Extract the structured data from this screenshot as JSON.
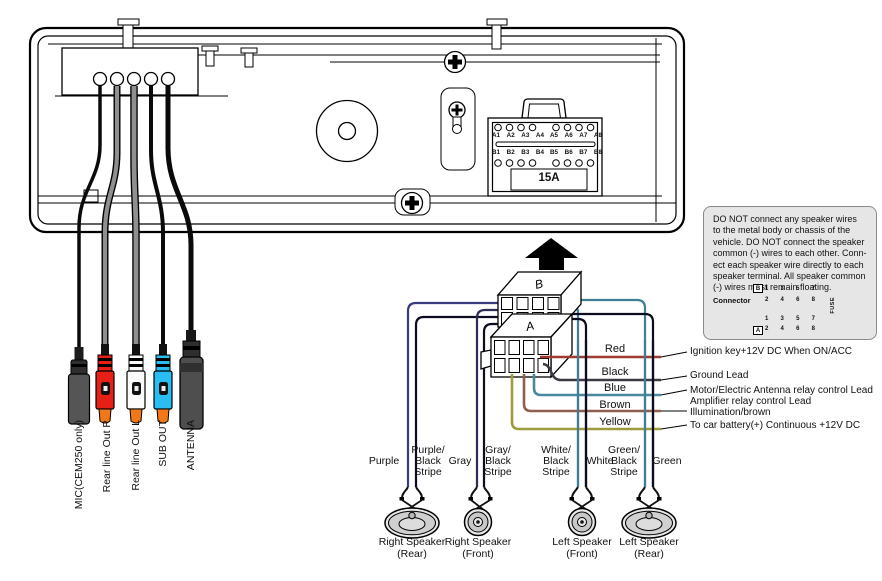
{
  "unit": {
    "pin_labels_a": [
      "A1",
      "A2",
      "A3",
      "A4",
      "A5",
      "A6",
      "A7",
      "A8"
    ],
    "pin_labels_b": [
      "B1",
      "B2",
      "B3",
      "B4",
      "B5",
      "B6",
      "B7",
      "B8"
    ],
    "fuse_label": "15A"
  },
  "harness": {
    "block_a_label": "A",
    "block_b_label": "B"
  },
  "outputs": {
    "items": [
      {
        "label": "MIC(CEM250 only)",
        "plug_color": "#555555"
      },
      {
        "label": "Rear line Out R",
        "plug_color": "#e62017"
      },
      {
        "label": "Rear line Out L",
        "plug_color": "#fcfcfc"
      },
      {
        "label": "SUB OUT",
        "plug_color": "#29bdf2"
      },
      {
        "label": "ANTENNA",
        "plug_color": "#4e4e4e"
      }
    ],
    "tip_color": "#f07818"
  },
  "power_wires": {
    "items": [
      {
        "color_label": "Red",
        "hex": "#9e3a32",
        "description": "Ignition key+12V DC When ON/ACC"
      },
      {
        "color_label": "Black",
        "hex": "#3a3a42",
        "description": "Ground Lead"
      },
      {
        "color_label": "Blue",
        "hex": "#4a87a0",
        "description": "Motor/Electric Antenna relay control Lead",
        "description2": "Amplifier relay control Lead"
      },
      {
        "color_label": "Brown",
        "hex": "#8e5f4e",
        "description": "Illumination/brown"
      },
      {
        "color_label": "Yellow",
        "hex": "#9c9c3c",
        "description": "To car battery(+) Continuous +12V DC"
      }
    ]
  },
  "speakers": {
    "items": [
      {
        "left_lines": [
          "Purple"
        ],
        "right_lines": [
          "Purple/",
          "Black",
          "Stripe"
        ],
        "name_lines": [
          "Right Speaker",
          "(Rear)"
        ],
        "shape": "oval"
      },
      {
        "left_lines": [
          "Gray"
        ],
        "right_lines": [
          "Gray/",
          "Black",
          "Stripe"
        ],
        "name_lines": [
          "Right Speaker",
          "(Front)"
        ],
        "shape": "round"
      },
      {
        "left_lines": [
          "White/",
          "Black",
          "Stripe"
        ],
        "right_lines": [
          "White"
        ],
        "name_lines": [
          "Left Speaker",
          "(Front)"
        ],
        "shape": "round"
      },
      {
        "left_lines": [
          "Green/",
          "Black",
          "Stripe"
        ],
        "right_lines": [
          "Green"
        ],
        "name_lines": [
          "Left Speaker",
          "(Rear)"
        ],
        "shape": "oval"
      }
    ]
  },
  "note_box": {
    "lines": [
      "DO NOT connect any speaker wires",
      "to the metal body or chassis of the",
      "vehicle. DO NOT connect the speaker",
      "common (-) wires to each other. Conn-",
      "ect each speaker wire directly to each",
      "speaker terminal. All speaker common",
      "(-) wires must remain floating."
    ],
    "connector_label": "Connector",
    "fuse_label": "FUSE",
    "block_a_label": "A",
    "block_b_label": "B",
    "pin_numbers_top": [
      "1",
      "3",
      "5",
      "7"
    ],
    "pin_numbers_bottom": [
      "2",
      "4",
      "6",
      "8"
    ]
  }
}
